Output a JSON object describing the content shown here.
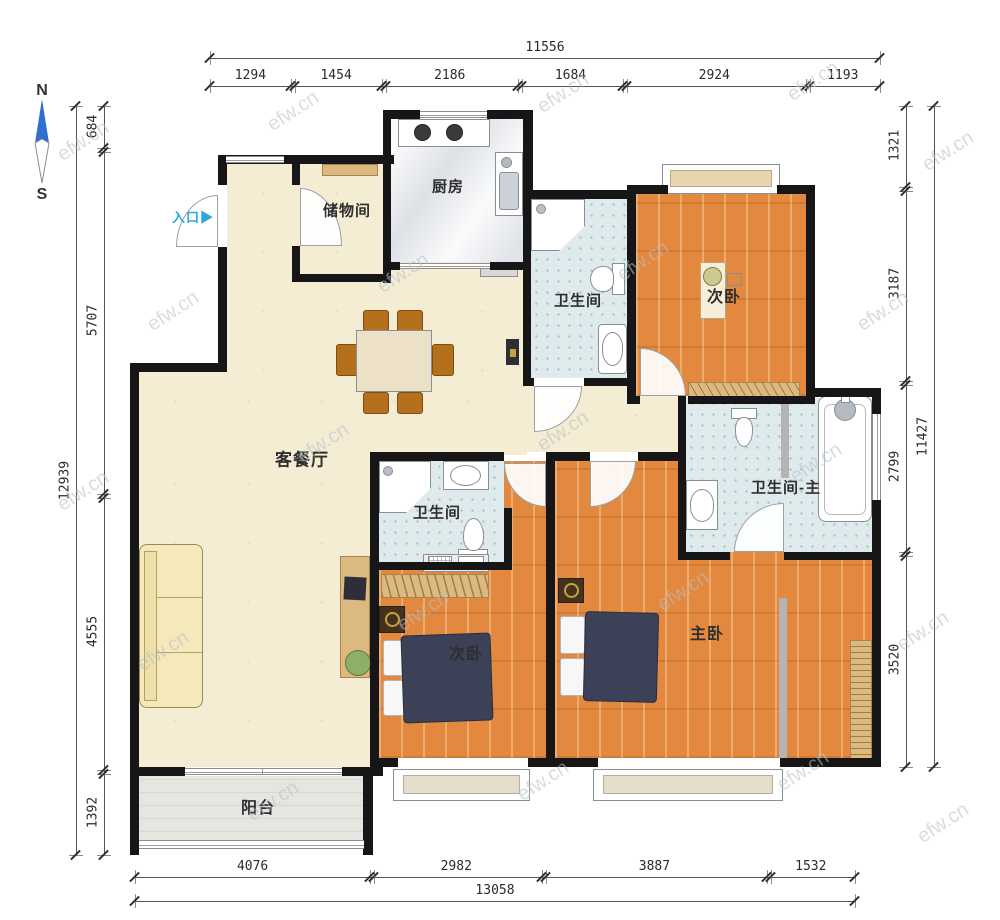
{
  "compass": {
    "north_label": "N",
    "south_label": "S",
    "needle_color": "#2e6fd0"
  },
  "watermark": {
    "text": "efw.cn"
  },
  "entrance": {
    "label": "入口",
    "arrow": "▶",
    "color": "#2ba7da"
  },
  "rooms": {
    "living_dining": {
      "label": "客餐厅"
    },
    "kitchen": {
      "label": "厨房"
    },
    "storage": {
      "label": "储物间"
    },
    "bath_top": {
      "label": "卫生间"
    },
    "bedroom_top": {
      "label": "次卧"
    },
    "bath_mid": {
      "label": "卫生间"
    },
    "bath_master": {
      "label": "卫生间-主"
    },
    "bedroom_mid": {
      "label": "次卧"
    },
    "bedroom_master": {
      "label": "主卧"
    },
    "balcony": {
      "label": "阳台"
    }
  },
  "dimensions": {
    "top": {
      "total": "11556",
      "segments": [
        "1294",
        "1454",
        "2186",
        "1684",
        "2924",
        "1193"
      ]
    },
    "bottom": {
      "total": "13058",
      "segments": [
        "4076",
        "2982",
        "3887",
        "1532"
      ]
    },
    "left": {
      "total": "12939",
      "segments": [
        "684",
        "5707",
        "4555",
        "1392"
      ]
    },
    "right": {
      "total": "11427",
      "segments": [
        "1321",
        "3187",
        "2799",
        "3520"
      ]
    }
  }
}
